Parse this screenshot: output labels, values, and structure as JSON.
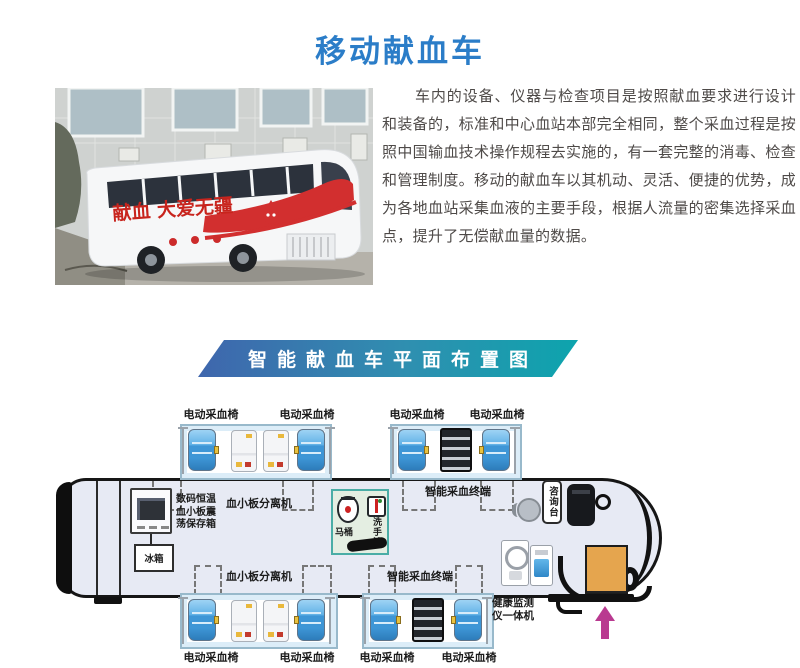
{
  "page": {
    "title": "移动献血车",
    "title_color": "#2b7dc8"
  },
  "intro": {
    "paragraph": "车内的设备、仪器与检查项目是按照献血要求进行设计和装备的，标准和中心血站本部完全相同，整个采血过程是按照中国输血技术操作规程去实施的，有一套完整的消毒、检查和管理制度。移动的献血车以其机动、灵活、便捷的优势，成为各地血站采集血液的主要手段，根据人流量的密集选择采血点，提升了无偿献血量的数据。"
  },
  "photo": {
    "bus_slogan": "献血 大爱无疆",
    "slogan_color": "#c8241d"
  },
  "banner": {
    "title": "智能献血车平面布置图",
    "gradient_start": "#3f66ad",
    "gradient_end": "#0da4ad"
  },
  "floor_plan": {
    "top_chair_labels": [
      "电动采血椅",
      "电动采血椅",
      "电动采血椅",
      "电动采血椅"
    ],
    "bottom_chair_labels": [
      "电动采血椅",
      "电动采血椅",
      "电动采血椅",
      "电动采血椅"
    ],
    "platelet_separator_top": "血小板分离机",
    "platelet_separator_bottom": "血小板分离机",
    "smart_terminal_top": "智能采血终端",
    "smart_terminal_bottom": "智能采血终端",
    "storage_box_lines": [
      "数码恒温",
      "血小板震",
      "荡保存箱"
    ],
    "fridge": "冰箱",
    "toilet": "马桶",
    "sink": "洗手池",
    "consult_desk": "咨询台",
    "health_monitor_lines": [
      "健康监测",
      "仪一体机"
    ],
    "colors": {
      "chair_blue": "#3e96d6",
      "entrance_steps": "#e5a54e",
      "entrance_arrow": "#b93a90",
      "toilet_room": "#e4eee2"
    }
  }
}
